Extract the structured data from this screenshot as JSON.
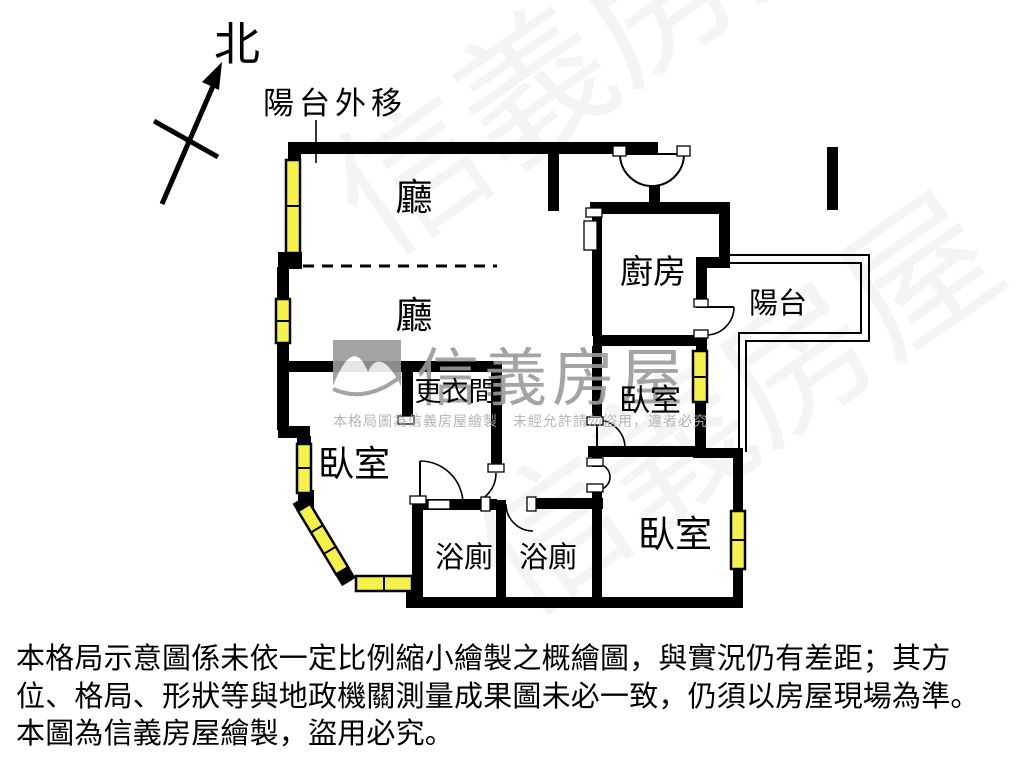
{
  "meta": {
    "width": 1024,
    "height": 768,
    "background": "#ffffff"
  },
  "colors": {
    "wall": "#000000",
    "window_fill": "#f5f14b",
    "watermark_gray": "#9b9b9b",
    "watermark_light": "#adadad"
  },
  "compass": {
    "label": "北"
  },
  "annotations": {
    "balcony_moved": "陽台外移"
  },
  "rooms": {
    "hall_upper": "廳",
    "hall_lower": "廳",
    "kitchen": "廚房",
    "balcony": "陽台",
    "bedroom_left": "臥室",
    "bedroom_middle": "臥室",
    "bedroom_right": "臥室",
    "closet": "更衣間",
    "bath_left": "浴廁",
    "bath_right": "浴廁"
  },
  "watermark": {
    "brand": "信義房屋",
    "notice": "本格局圖為信義房屋繪製　未經允許請勿盜用，違者必究"
  },
  "disclaimer": {
    "line1": "本格局示意圖係未依一定比例縮小繪製之概繪圖，與實況仍有差距；其方",
    "line2": "位、格局、形狀等與地政機關測量成果圖未必一致，仍須以房屋現場為準。",
    "line3": "本圖為信義房屋繪製，盜用必究。"
  }
}
